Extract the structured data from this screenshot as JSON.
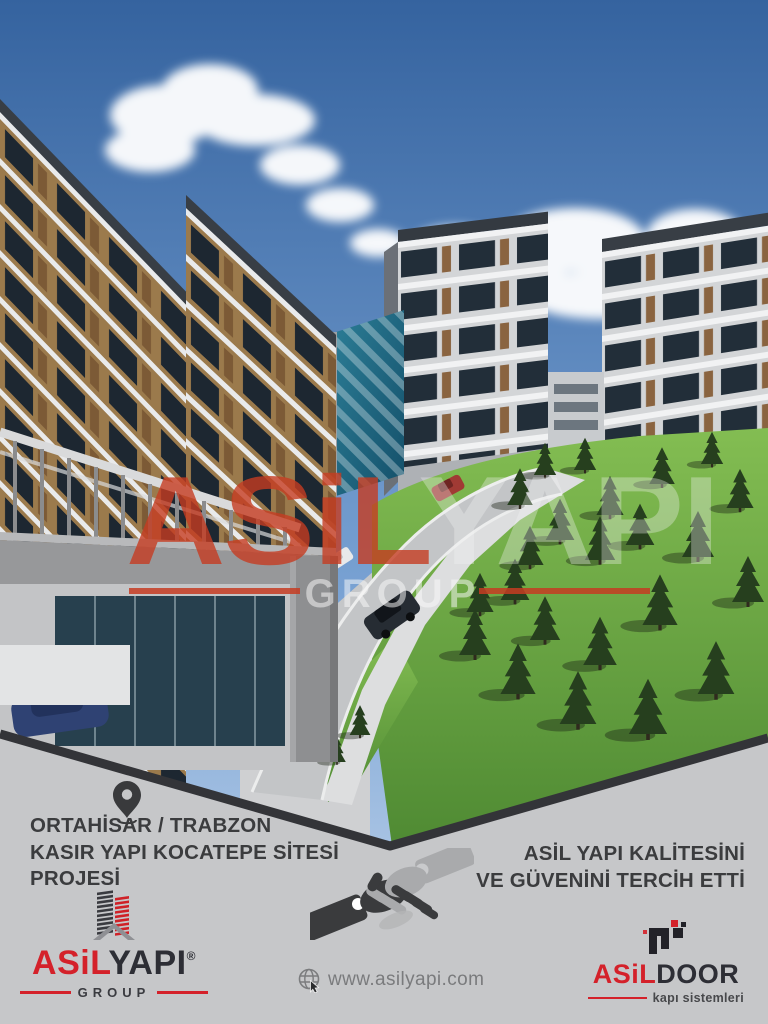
{
  "poster": {
    "hero": {
      "watermark": {
        "brand_red": "ASiL",
        "brand_gray": "YAPI",
        "sub": "GROUP"
      }
    },
    "info": {
      "location": "ORTAHİSAR / TRABZON",
      "project_line1": "KASIR YAPI KOCATEPE SİTESİ",
      "project_line2": "PROJESİ",
      "testimonial_line1": "ASİL YAPI KALİTESİNİ",
      "testimonial_line2": "VE GÜVENİNİ TERCİH ETTİ"
    },
    "footer": {
      "asilyapi": {
        "brand_red": "ASiL",
        "brand_dark": "YAPI",
        "registered": "®",
        "sub": "GROUP"
      },
      "website": "www.asilyapi.com",
      "asildoor": {
        "brand_red": "ASiL",
        "brand_dark": "DOOR",
        "tagline": "kapı sistemleri"
      }
    },
    "colors": {
      "accent_red": "#d4212a",
      "text_dark": "#3b3c3e",
      "panel_bg": "#c6c7c9",
      "edge_line": "#333438",
      "sky_blue": "#35639f",
      "grass_green": "#6fae45"
    }
  }
}
